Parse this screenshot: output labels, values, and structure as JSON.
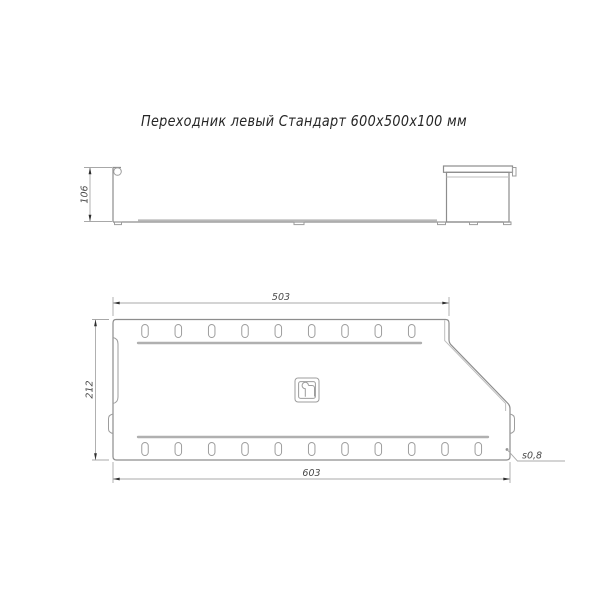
{
  "title": "Переходник левый Стандарт 600х500х100 мм",
  "side_view": {
    "height_dim": "106"
  },
  "plan_view": {
    "top_length_dim": "503",
    "bottom_length_dim": "603",
    "width_dim": "212",
    "thickness_callout": "s0,8"
  },
  "icons": {
    "logo": "manufacturer-monogram-icon"
  },
  "colors": {
    "background": "#ffffff",
    "outline": "#8d8d8d",
    "light_line": "#bdbdbd",
    "dimension_line": "#a8a8a8",
    "arrow": "#2e2e2e",
    "title_text": "#262626",
    "dimension_text": "#4a4a4a"
  }
}
